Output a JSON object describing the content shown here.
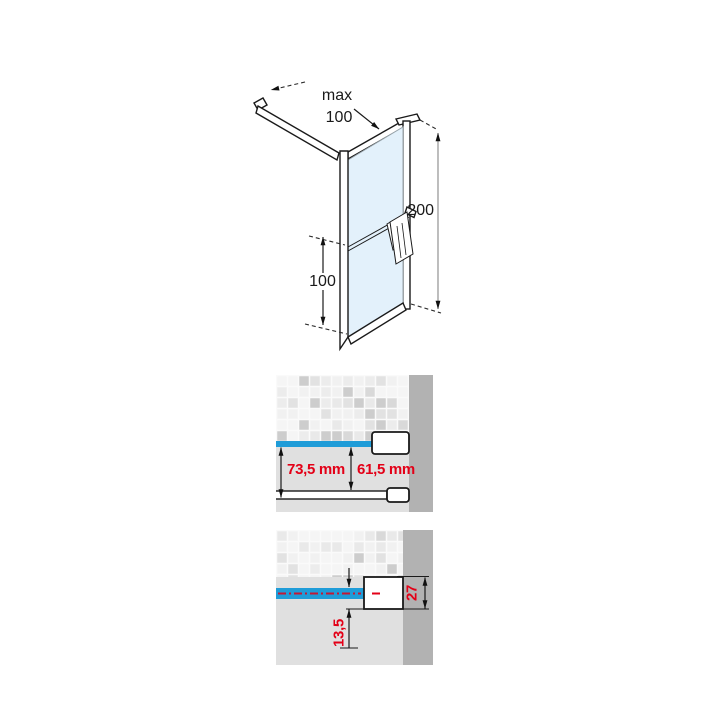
{
  "iso_view": {
    "label_max": "max",
    "label_width": "100",
    "label_height": "200",
    "label_bar_height": "100"
  },
  "offset_view": {
    "label_outer": "73,5 mm",
    "label_inner": "61,5 mm"
  },
  "profile_view": {
    "label_depth": "27",
    "label_half": "13,5"
  },
  "colors": {
    "accent_blue": "#1f9cd8",
    "glass_blue": "#e3f1fb",
    "dimension_red": "#e30017",
    "wall_gray": "#b2b2b2",
    "floor_gray": "#e0e0e0"
  }
}
